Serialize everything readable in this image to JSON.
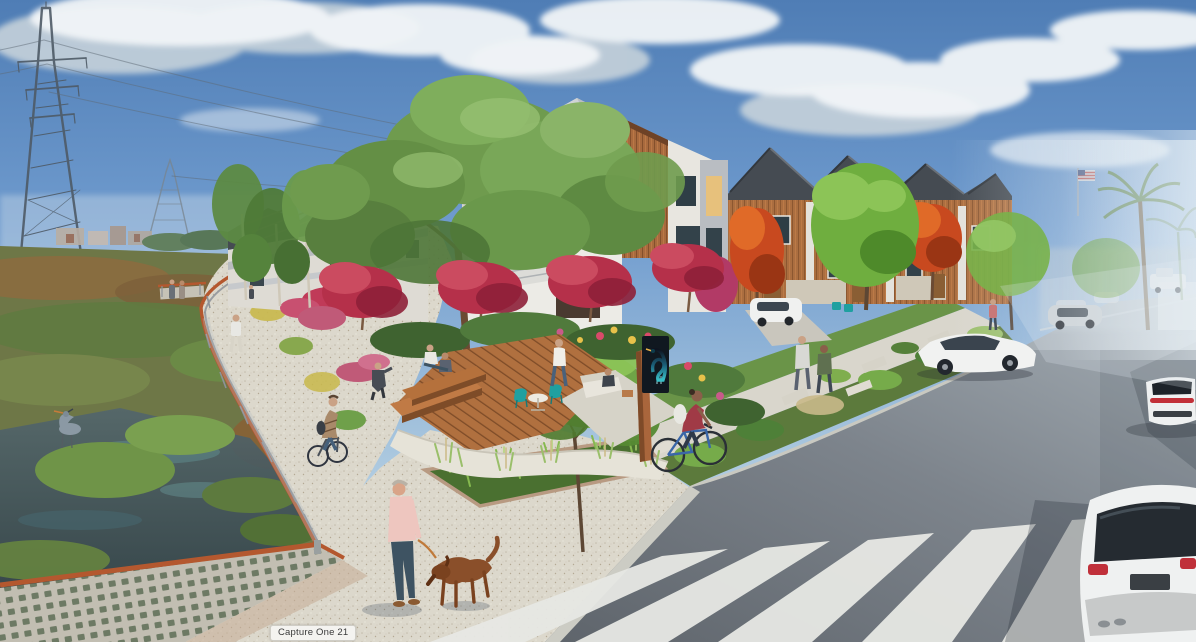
{
  "meta": {
    "kind": "architectural-rendering",
    "subject": "Modern townhome development beside a wetland greenway channel, with a corner plaza deck, heron wayfinding sign, street crosswalk, cars, cyclists and pedestrians",
    "time_of_day": "daytime"
  },
  "watermark": {
    "label": "Capture One 21"
  },
  "palette": {
    "sky_top": "#4f7db5",
    "sky_horizon": "#d9e6ee",
    "cloud": "#f2f5f7",
    "marsh_green": "#6e7747",
    "marsh_rust": "#8d6b40",
    "water_dark": "#3c4e57",
    "gravel": "#dcd8cc",
    "asphalt_dark": "#5e646b",
    "asphalt_light": "#9aa4ac",
    "crosswalk_stripe": "#e7e8e4",
    "deck_wood": "#b0703f",
    "siding_wood": "#a86a3e",
    "building_white": "#ecebe6",
    "roof_dark": "#474d54",
    "corten_rail": "#b4582f",
    "tree_green": "#6f9b4e",
    "crape_myrtle_red": "#b5304a",
    "autumn_orange": "#c8491f",
    "chair_teal": "#21a3a3",
    "sign_panel": "#101820",
    "heron_teal": "#39c0c8",
    "shirt_pink": "#eec6bf",
    "dog_brown": "#8a4f2a"
  },
  "scene": {
    "landmarks": [
      {
        "name": "transmission-tower",
        "desc": "lattice high-voltage pylon with sagging power lines, upper left"
      },
      {
        "name": "wetland-channel",
        "desc": "marsh and open water with a great blue heron, lower left"
      },
      {
        "name": "greenway-path",
        "desc": "curving decomposed-granite trail with corten-topped railing, walkers and a cyclist"
      },
      {
        "name": "townhomes",
        "desc": "three-story modern rowhouses, white stucco and orange wood siding, gabled gray roofs"
      },
      {
        "name": "corner-plaza",
        "desc": "wood deck with steps, teal cafe chairs, white table, ornamental grasses"
      },
      {
        "name": "heron-sign",
        "desc": "dark monument sign with teal heron graphic on a wood post"
      },
      {
        "name": "street",
        "desc": "asphalt street with zebra crosswalk, moving and parked white cars"
      },
      {
        "name": "foreground",
        "desc": "man in pink shirt walking a brown dog across the gravel plaza"
      },
      {
        "name": "american-flag",
        "desc": "small US flag on a pole in the distance, upper right"
      },
      {
        "name": "palm-trees",
        "desc": "hazy palm trees down the street, upper right"
      }
    ]
  }
}
